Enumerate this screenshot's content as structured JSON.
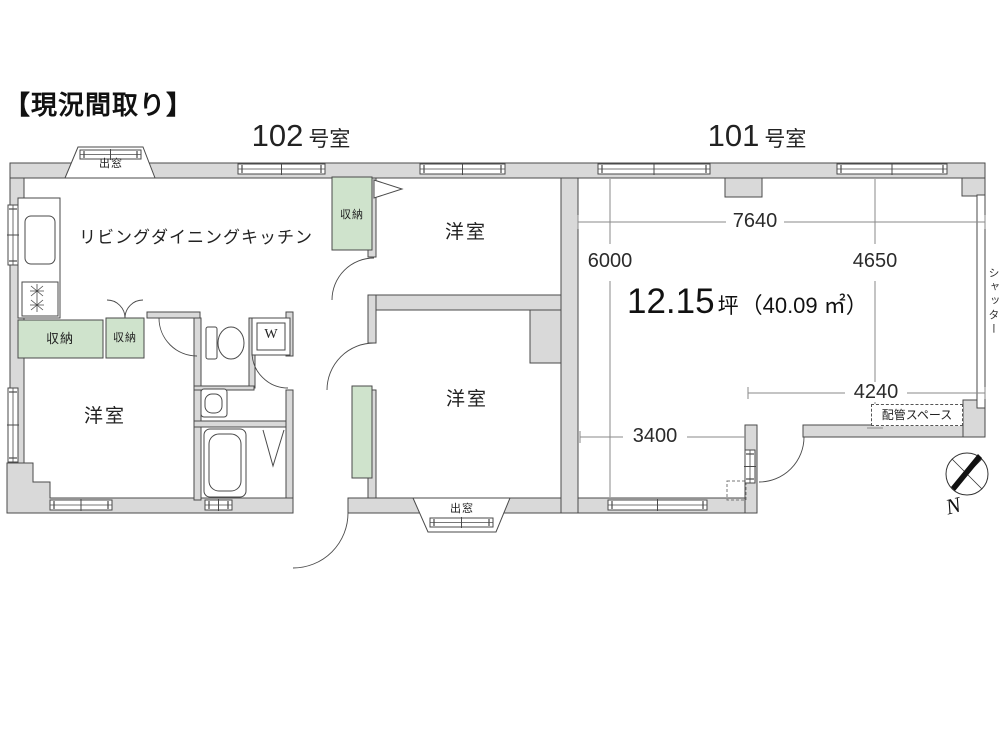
{
  "title": "【現況間取り】",
  "unit_102": {
    "number": "102",
    "suffix": "号室"
  },
  "unit_101": {
    "number": "101",
    "suffix": "号室"
  },
  "rooms": {
    "ldk": "リビングダイニングキッチン",
    "western_top": "洋室",
    "western_bottom": "洋室",
    "western_left": "洋室"
  },
  "storages": {
    "s1": "収納",
    "s2": "収納",
    "s3": "収納"
  },
  "bay_windows": {
    "top": "出窓",
    "bottom": "出窓"
  },
  "area": {
    "value": "12.15",
    "unit": "坪",
    "sqm": "（40.09 ㎡）"
  },
  "dimensions": {
    "width_total": "7640",
    "height_left": "6000",
    "height_right": "4650",
    "width_bottom_right": "4240",
    "width_bottom_left": "3400"
  },
  "labels": {
    "shutter": "シャッター",
    "pipe_space": "配管スペース",
    "washer": "W",
    "compass_north": "N"
  },
  "colors": {
    "wall_fill": "#d9d9d9",
    "storage_fill": "#cfe3cc",
    "line": "#4a4a4a",
    "dimension_text": "#2b2b2b"
  }
}
